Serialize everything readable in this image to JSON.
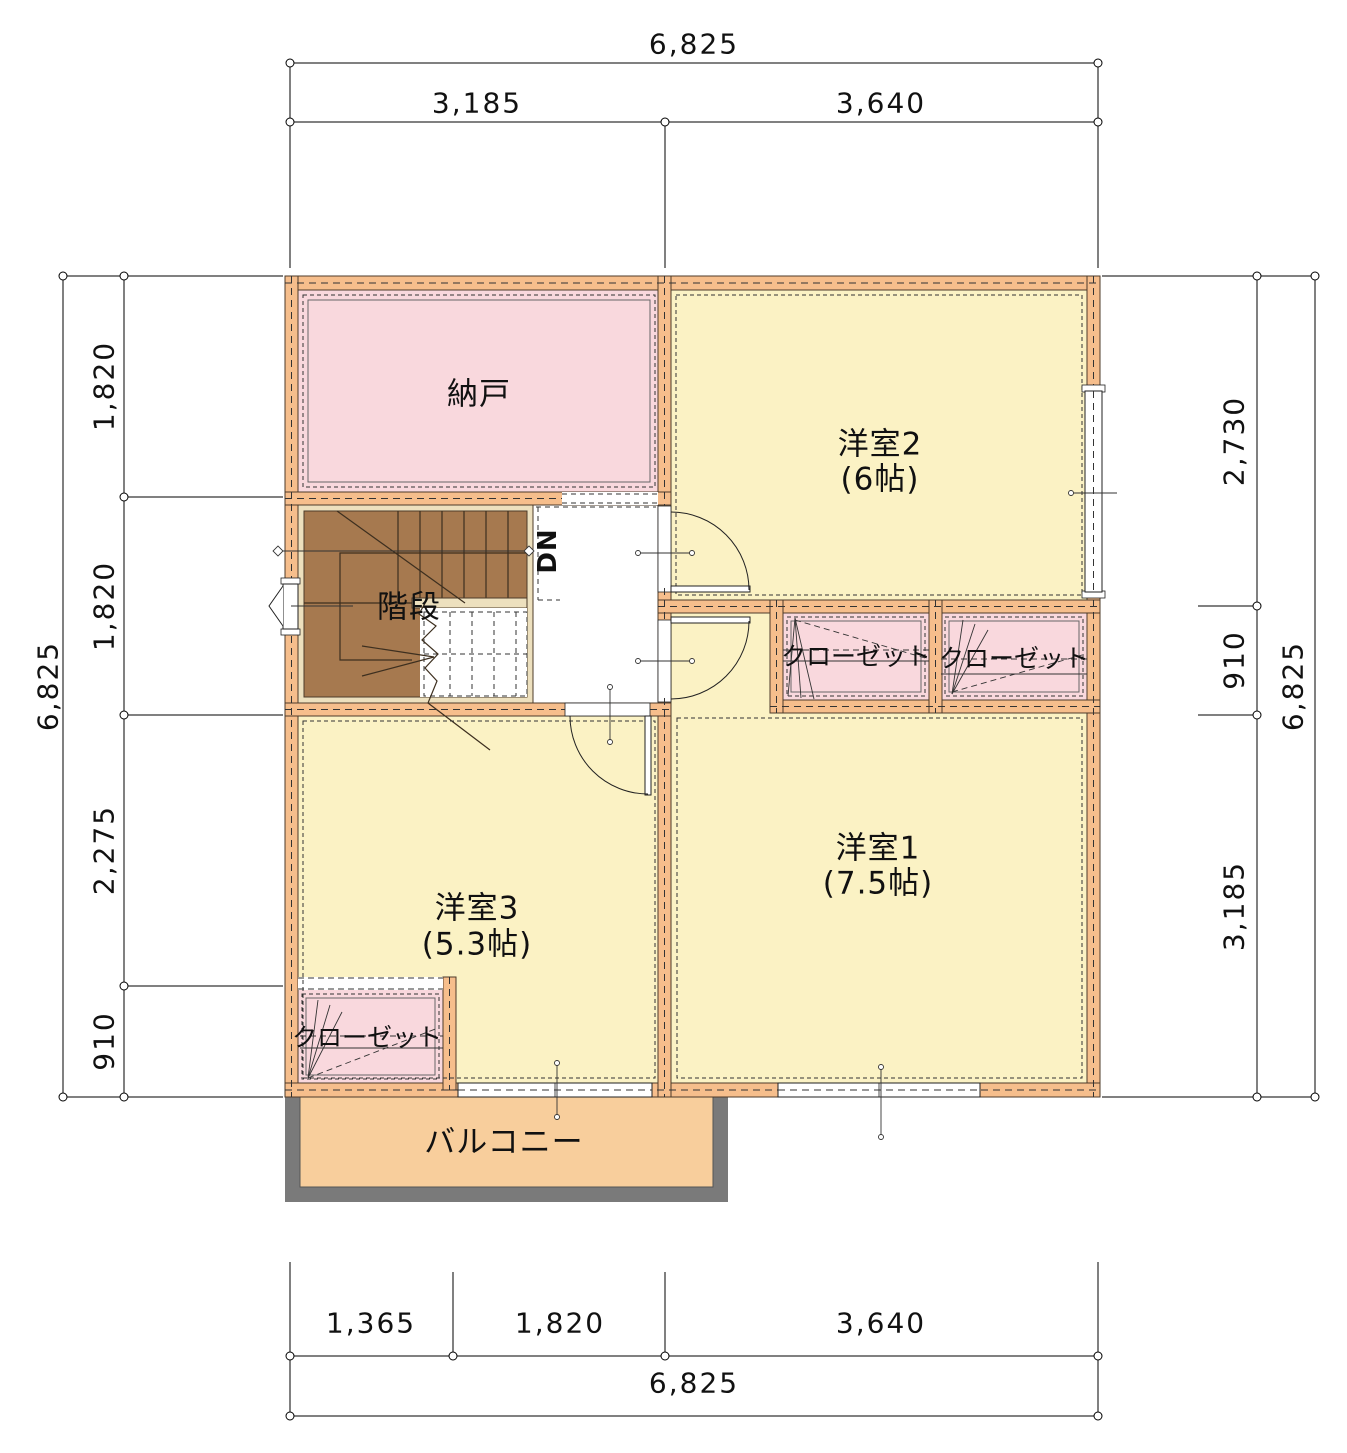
{
  "rooms": {
    "nando": {
      "label": "納戸"
    },
    "yoshitsu2": {
      "label": "洋室2",
      "size": "(6帖)"
    },
    "yoshitsu1": {
      "label": "洋室1",
      "size": "(7.5帖)"
    },
    "yoshitsu3": {
      "label": "洋室3",
      "size": "(5.3帖)"
    },
    "stairs": {
      "label": "階段",
      "down_label": "DN"
    },
    "closet_a": {
      "label": "クローゼット"
    },
    "closet_b": {
      "label": "クローゼット"
    },
    "closet_c": {
      "label": "クローゼット"
    },
    "balcony": {
      "label": "バルコニー"
    }
  },
  "dimensions": {
    "top": {
      "overall": "6,825",
      "segments": [
        "3,185",
        "3,640"
      ]
    },
    "bottom": {
      "overall": "6,825",
      "segments": [
        "1,365",
        "1,820",
        "3,640"
      ]
    },
    "left": {
      "overall": "6,825",
      "segments": [
        "1,820",
        "1,820",
        "2,275",
        "910"
      ]
    },
    "right": {
      "overall": "6,825",
      "segments": [
        "2,730",
        "910",
        "3,185"
      ]
    }
  },
  "colors": {
    "wall": "#F6BE8C",
    "wall_line": "#4D3B2A",
    "room_yellow": "#FBF2C4",
    "room_pink": "#F9D8DD",
    "hall_white": "#FFFFFF",
    "stair_brown": "#A6794F",
    "stair_trim": "#EDE0BE",
    "balcony_fill": "#F8CE9C",
    "balcony_frame": "#7A7A7A",
    "dash": "#333333",
    "line": "#222222",
    "text": "#111111"
  }
}
